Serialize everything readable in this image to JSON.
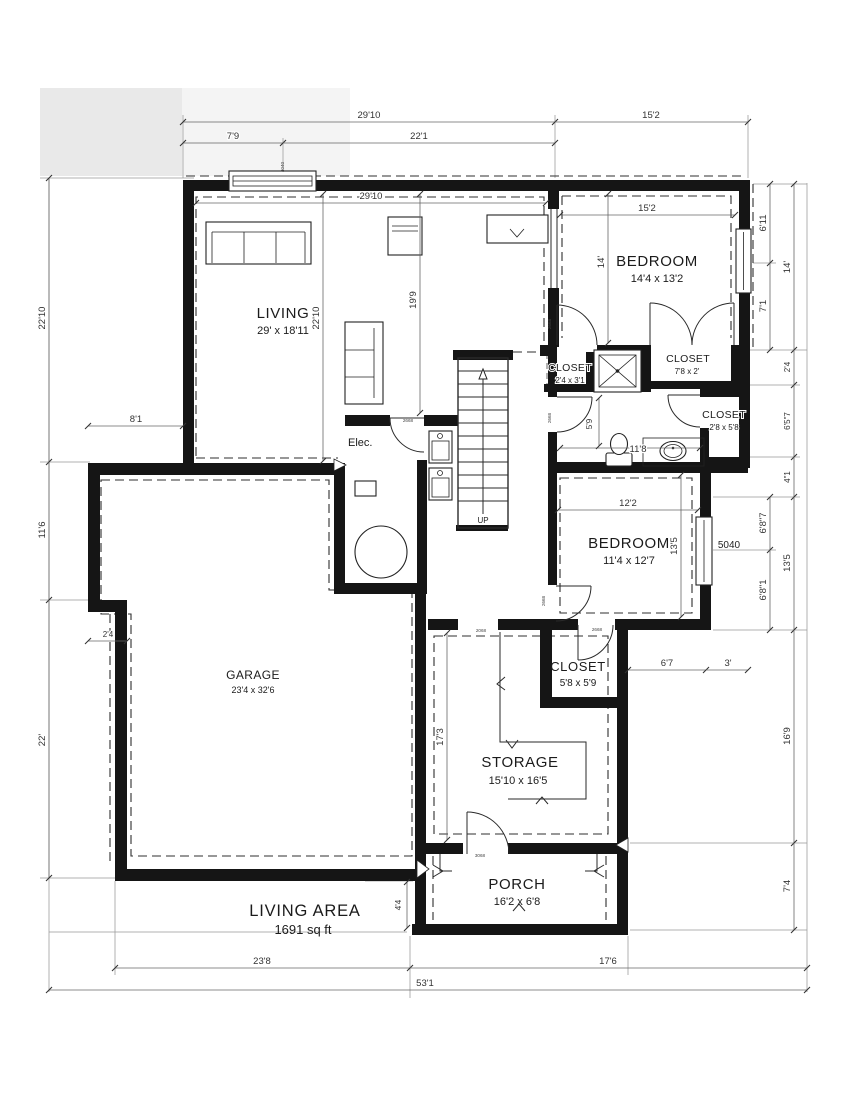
{
  "plan": {
    "rooms": {
      "living": {
        "name": "LIVING",
        "size": "29' x 18'11"
      },
      "bedroom_top": {
        "name": "BEDROOM",
        "size": "14'4 x 13'2"
      },
      "bedroom_mid": {
        "name": "BEDROOM",
        "size": "11'4 x 12'7"
      },
      "garage": {
        "name": "GARAGE",
        "size": "23'4 x 32'6"
      },
      "storage": {
        "name": "STORAGE",
        "size": "15'10 x 16'5"
      },
      "porch": {
        "name": "PORCH",
        "size": "16'2 x 6'8"
      },
      "closet_a": {
        "name": "CLOSET",
        "size": "2'4 x 3'1"
      },
      "closet_b": {
        "name": "CLOSET",
        "size": "7'8 x 2'"
      },
      "closet_c": {
        "name": "CLOSET",
        "size": "2'8 x 5'8"
      },
      "closet_d": {
        "name": "CLOSET",
        "size": "5'8 x 5'9"
      },
      "elec": {
        "name": "Elec."
      },
      "stairs_label": "UP"
    },
    "summary": {
      "label": "LIVING AREA",
      "value": "1691 sq ft"
    },
    "dims": {
      "top_total_left": "29'10",
      "top_left_a": "7'9",
      "top_left_b": "22'1",
      "top_total_right": "15'2",
      "living_width": "29'10",
      "living_height": "22'10",
      "hall_height": "19'9",
      "bed1_width": "15'2",
      "bed1_height": "14'",
      "left_upper": "22'10",
      "left_mid": "11'6",
      "left_step": "2'4",
      "left_lower": "22'",
      "garage_offset": "8'1",
      "right_win_top": "6'11",
      "right_win_bottom": "7'1",
      "right_bed1": "14'",
      "right_step": "2'4",
      "right_bath": "6'5\"7",
      "right_gap": "4\"1",
      "right_win2_top": "6'8\"7",
      "right_bed2": "13'5",
      "right_win2_bottom": "6'8\"1",
      "right_storage": "16'9",
      "right_porch": "7'4",
      "bath_width": "11'8",
      "bath_height": "5'9",
      "bed2_width": "12'2",
      "bed2_height": "13'5",
      "bed2_offset_a": "6'7",
      "bed2_offset_b": "3'",
      "storage_height": "17'3",
      "porch_offset": "4'4",
      "bottom_left": "23'8",
      "bottom_right": "17'6",
      "bottom_total": "53'1"
    },
    "tags": {
      "window_living": "4040",
      "window_bed2": "5040",
      "door_bed1": "2668",
      "door_bath": "2668",
      "door_bed2": "2668",
      "door_closet": "2668",
      "door_laundry": "2668",
      "door_storage": "2068",
      "door_porch": "3068"
    }
  }
}
